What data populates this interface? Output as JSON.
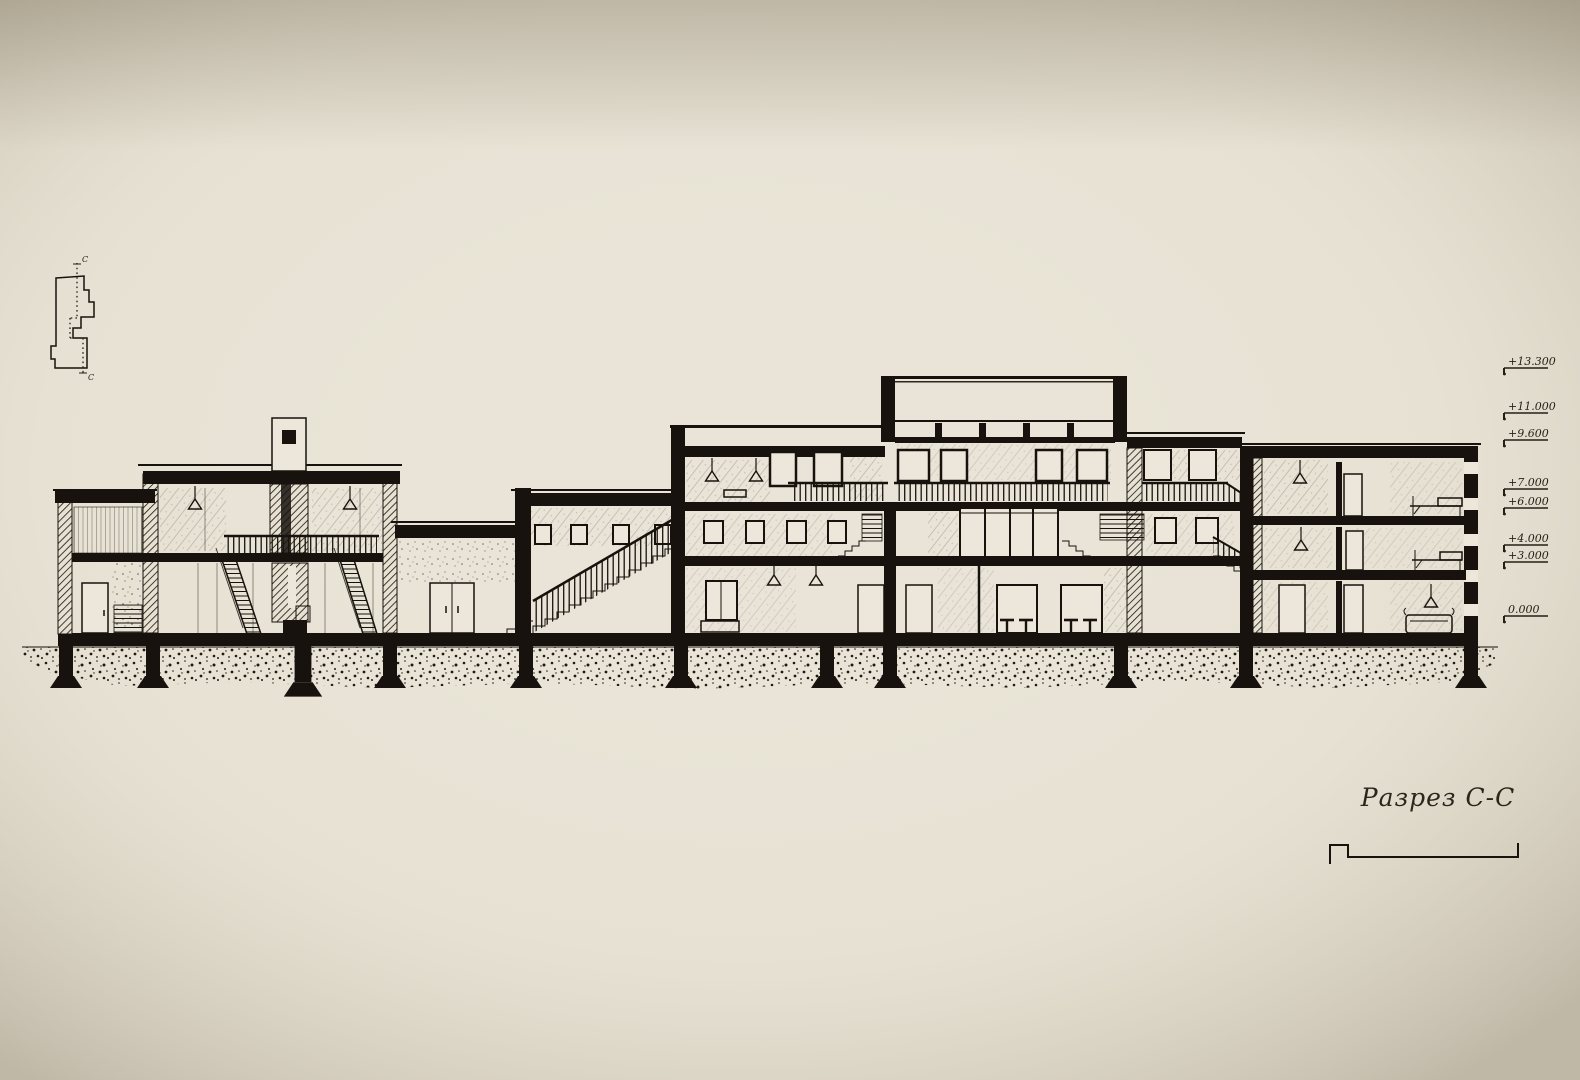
{
  "colors": {
    "paper": "#e9e4d7",
    "ink": "#17120d"
  },
  "title_block": {
    "label": "Разрез С-С"
  },
  "key_plan": {
    "top_mark": "С",
    "bottom_mark": "С"
  },
  "levels": {
    "items": [
      {
        "label": "+13.300"
      },
      {
        "label": "+11.000"
      },
      {
        "label": "+9.600"
      },
      {
        "label": "+7.000"
      },
      {
        "label": "+6.000"
      },
      {
        "label": "+4.000"
      },
      {
        "label": "+3.000"
      },
      {
        "label": "0.000"
      }
    ]
  }
}
